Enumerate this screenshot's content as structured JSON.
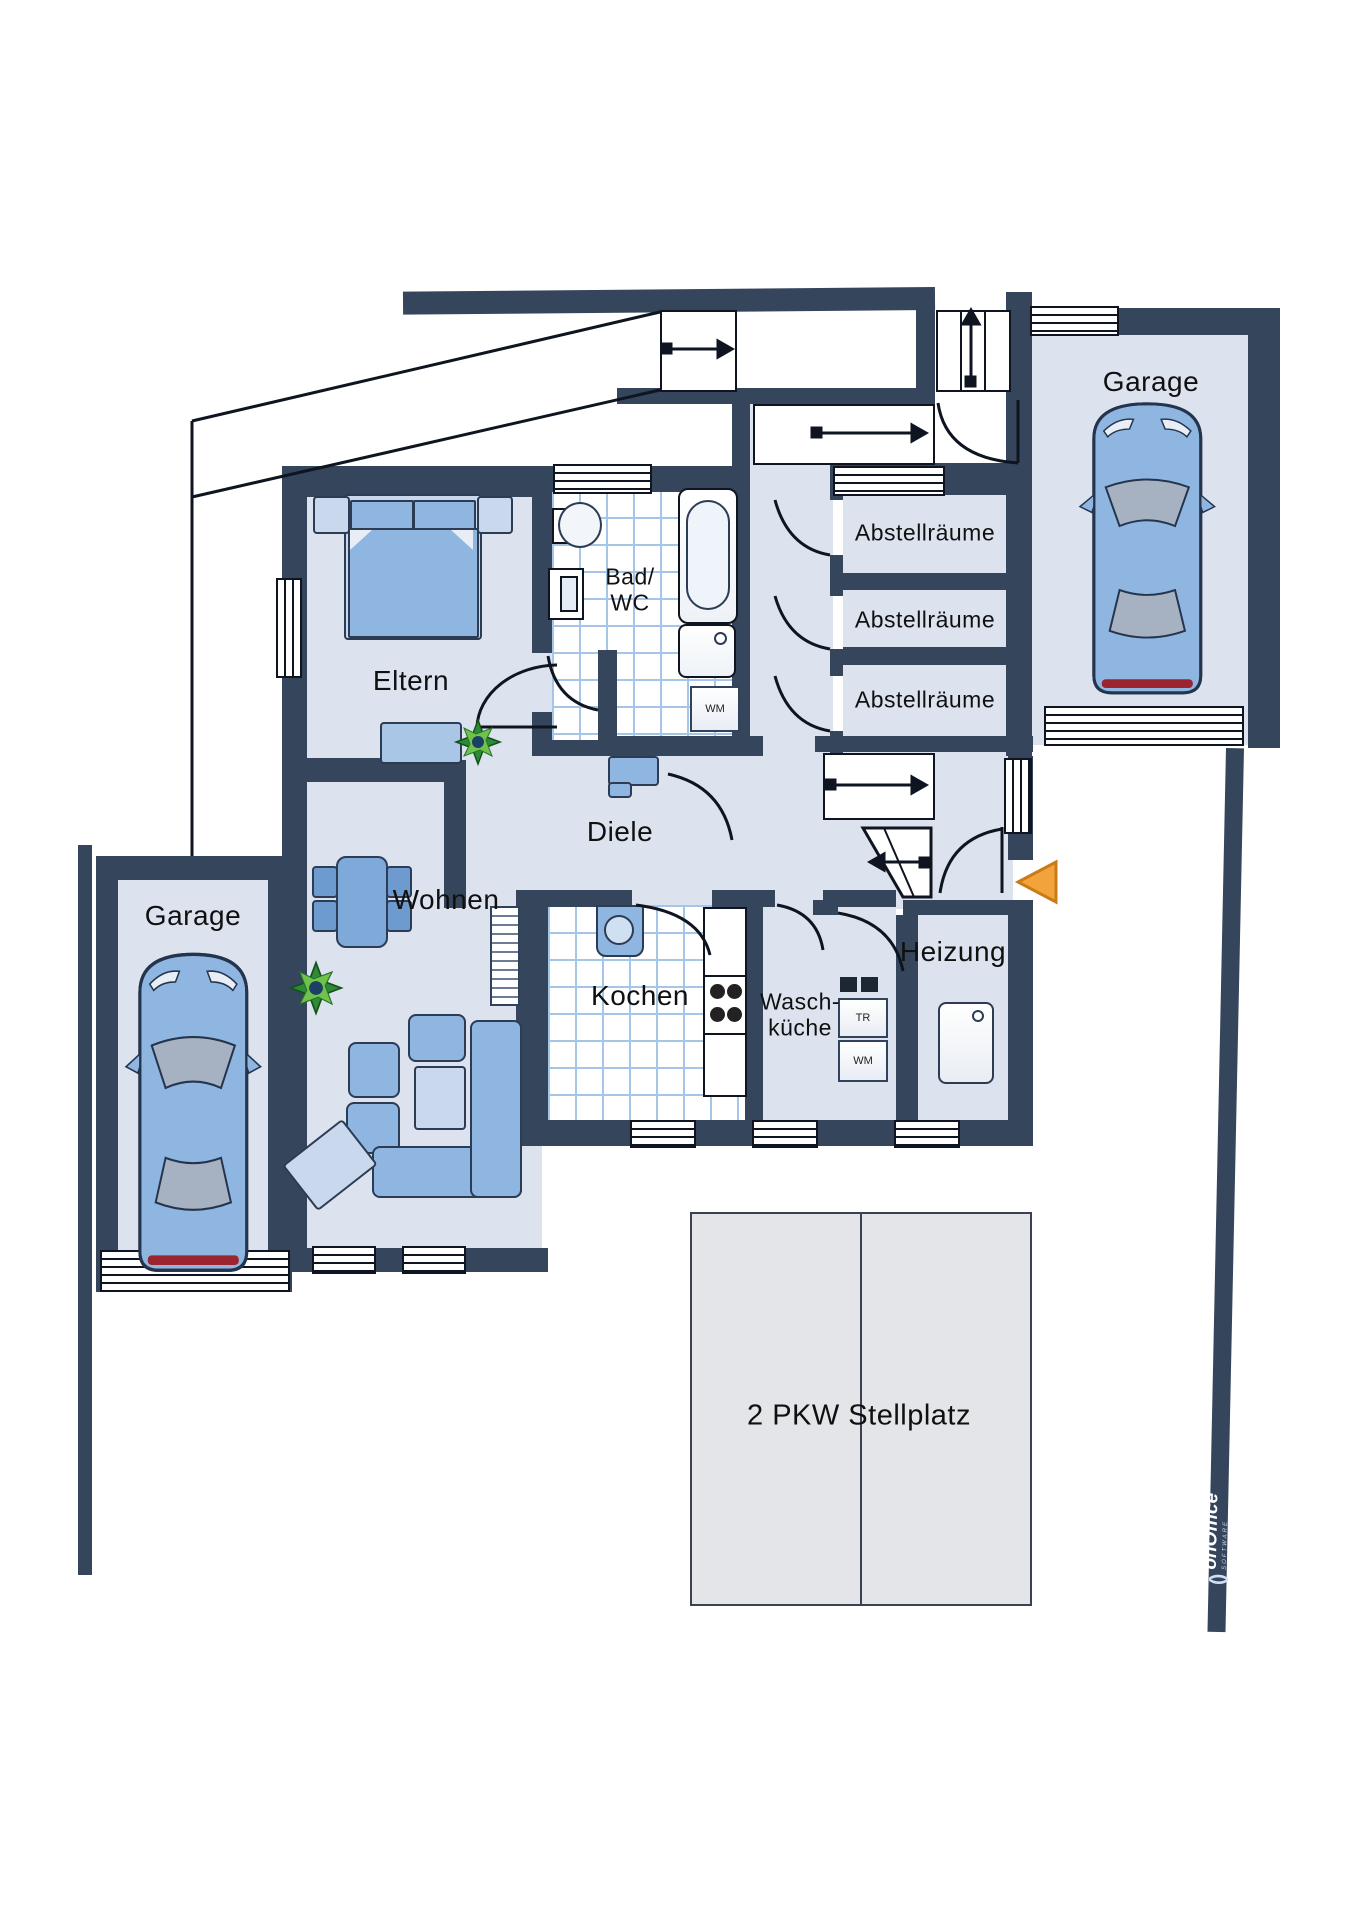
{
  "plan": {
    "type": "floor-plan",
    "labels": {
      "garage_top": "Garage",
      "garage_left": "Garage",
      "eltern": "Eltern",
      "bad": [
        "Bad/",
        "WC"
      ],
      "abstellraeume": [
        "Abstellräume",
        "Abstellräume",
        "Abstellräume"
      ],
      "diele": "Diele",
      "wohnen": "Wohnen",
      "kochen": "Kochen",
      "waschkueche": [
        "Wasch-",
        "küche"
      ],
      "heizung": "Heizung",
      "stellplatz": "2 PKW Stellplatz"
    },
    "appliances": {
      "wm_bad": "WM",
      "tr": "TR",
      "wm_wasch": "WM"
    },
    "branding": {
      "logo": "onOffice",
      "logo_sub": "SOFTWARE"
    },
    "colors": {
      "wall": "#35455C",
      "room": "#DCE3EF",
      "tile_line": "#A5C6E6",
      "furniture": "#8FB5E1",
      "furniture_light": "#C9D8EC",
      "parking": "#E3E5E9",
      "accent_orange": "#F2A33C",
      "plant_green": "#2E8B35",
      "car_body": "#8FB5E1"
    }
  }
}
